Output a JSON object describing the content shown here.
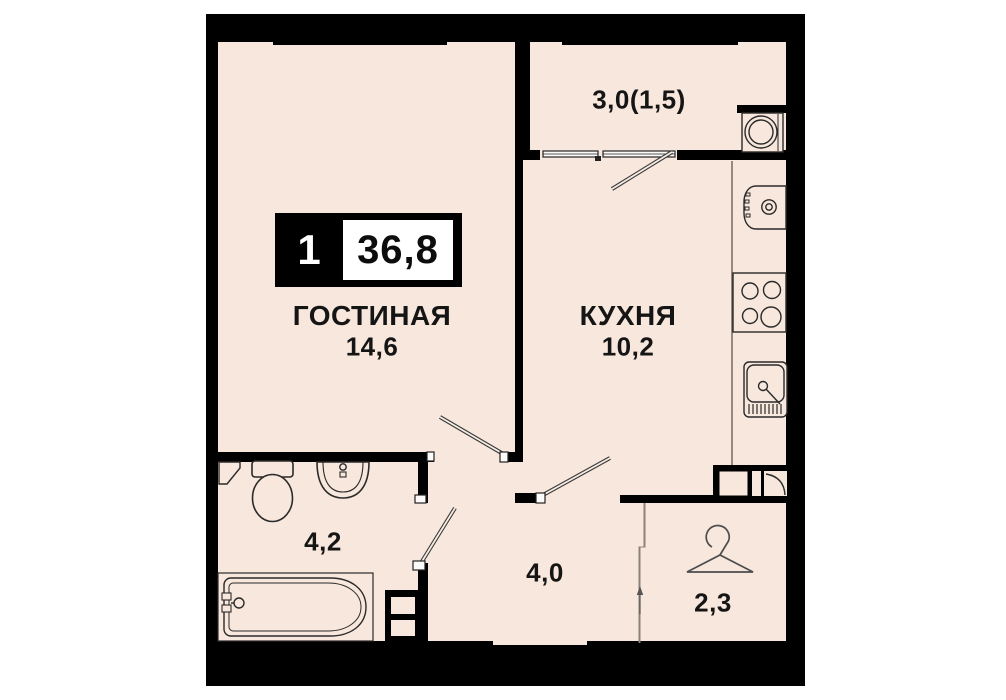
{
  "badge": {
    "rooms_count": "1",
    "total_area": "36,8"
  },
  "rooms": {
    "living": {
      "name": "ГОСТИНАЯ",
      "area": "14,6"
    },
    "kitchen": {
      "name": "КУХНЯ",
      "area": "10,2"
    },
    "balcony": {
      "area": "3,0(1,5)"
    },
    "bathroom": {
      "area": "4,2"
    },
    "hallway": {
      "area": "4,0"
    },
    "wardrobe": {
      "area": "2,3"
    }
  },
  "colors": {
    "floor": "#f8e7dc",
    "walls": "#000000",
    "background": "#ffffff",
    "fixture_outline": "#2a2a2a"
  },
  "icons": {
    "toilet-icon": "svg tank + bowl shape",
    "washbasin-icon": "svg half-oval basin with tap",
    "bathtub-icon": "svg rounded tub with faucet",
    "stove-icon": "svg 4-burner cooktop",
    "kitchen-sink-icon": "svg square sink with drain and drainer hatch",
    "boiler-icon": "svg rounded appliance with dial",
    "washing-machine-icon": "svg box with double drum circle",
    "hanger-icon": "svg clothes hanger",
    "vent-shaft-icon": "svg duct boxes",
    "door-leaf-icon": "svg diagonal door swing bar",
    "window-icon": "svg double glazing bars"
  }
}
